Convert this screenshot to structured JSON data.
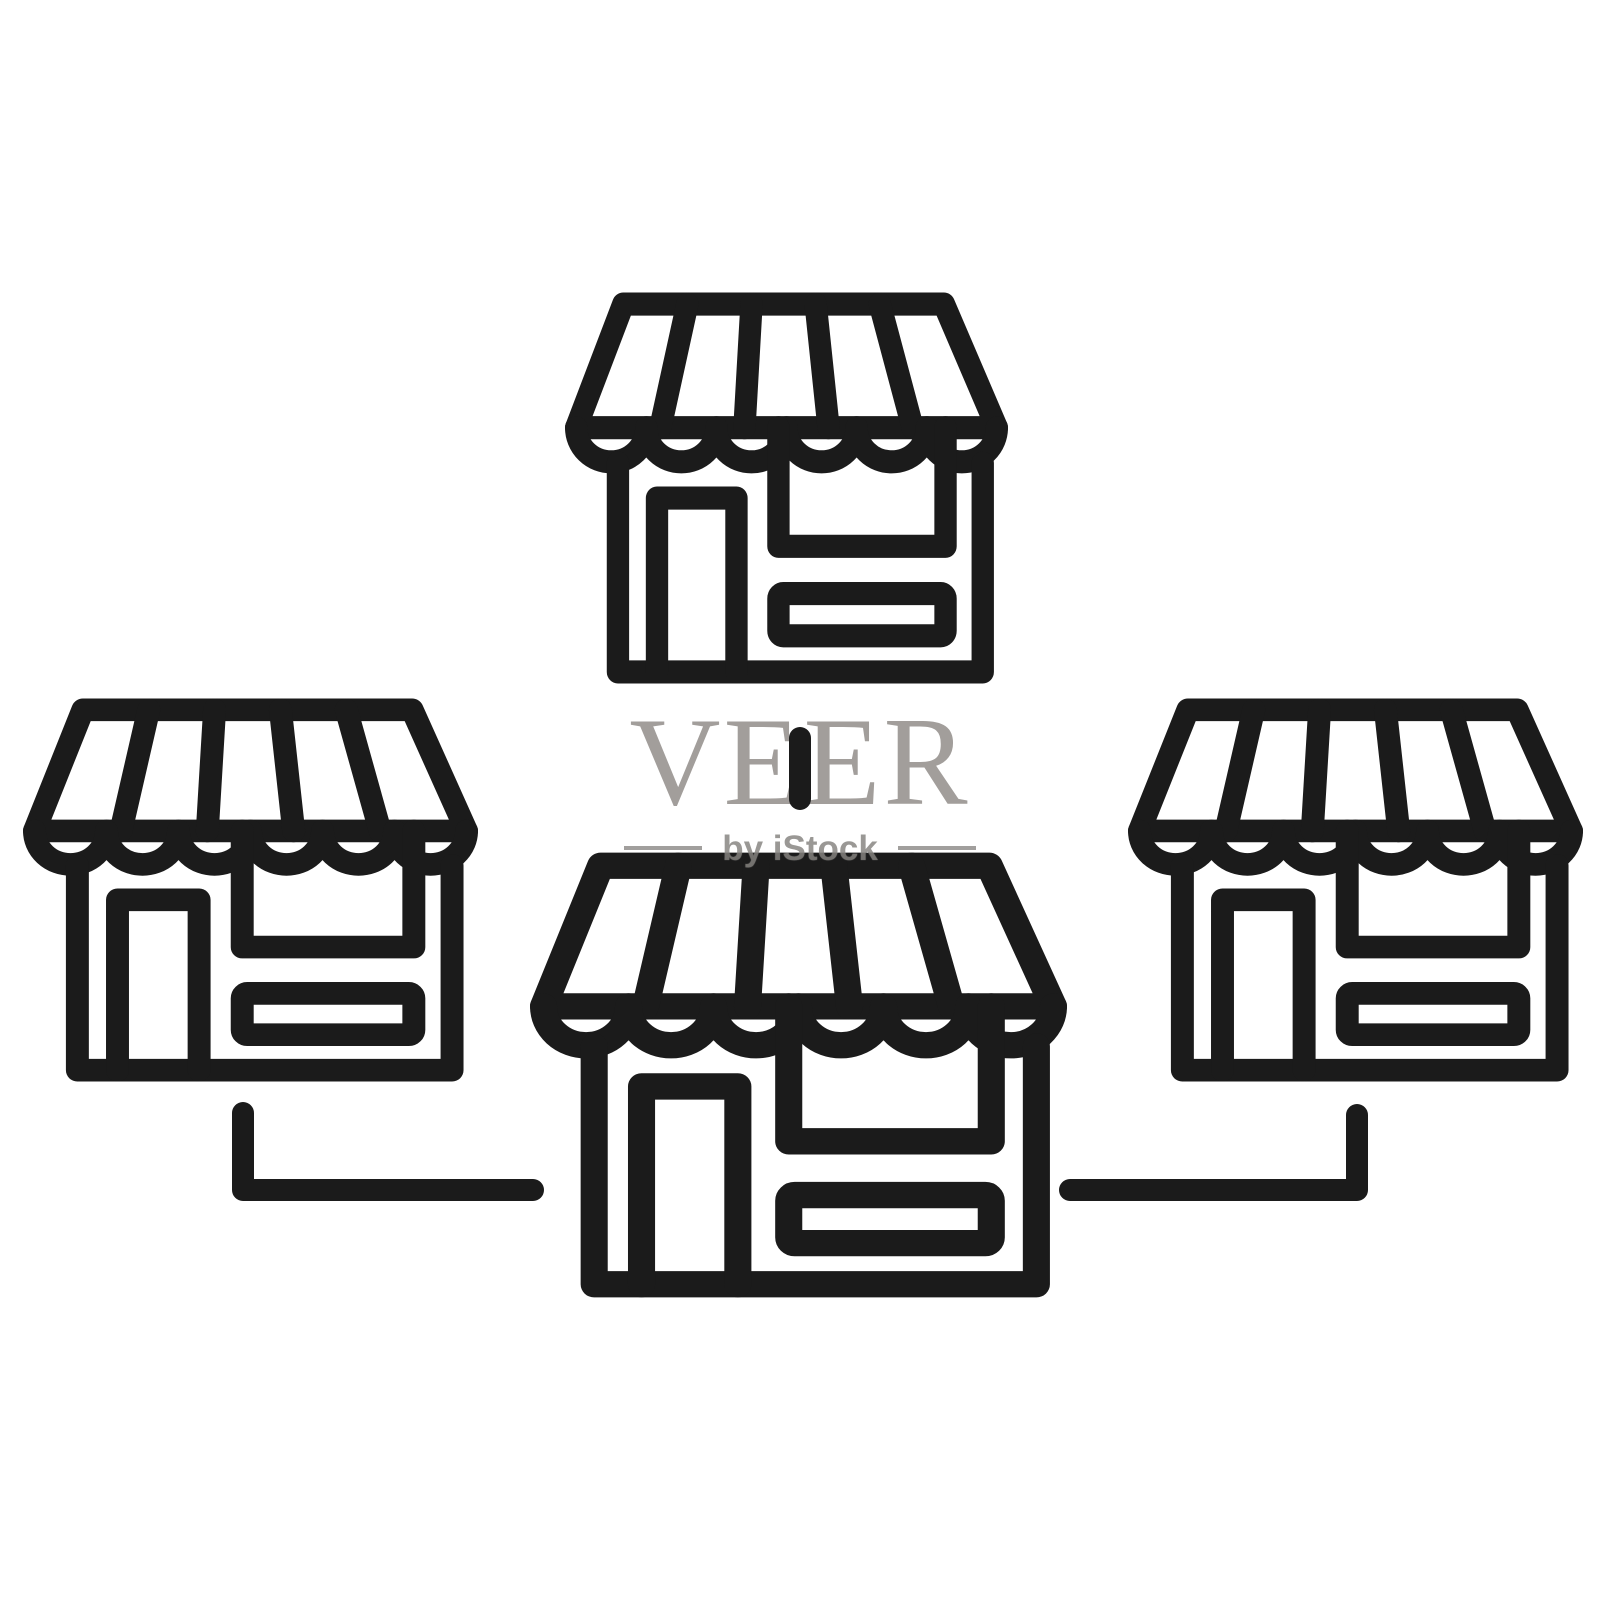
{
  "watermark": {
    "brand": "VEER",
    "byline": "by iStock"
  },
  "colors": {
    "background": "#ffffff",
    "icon_stroke": "#1b1b1b",
    "brand_gray": "#a29e9b",
    "byline_gray": "#78756f"
  },
  "diagram": {
    "description_icons": [
      "storefront-icon-top",
      "storefront-icon-left",
      "storefront-icon-center",
      "storefront-icon-right"
    ],
    "connectors": [
      "connector-top-to-center",
      "connector-left-to-center",
      "connector-right-to-center"
    ],
    "store_count": 4
  }
}
